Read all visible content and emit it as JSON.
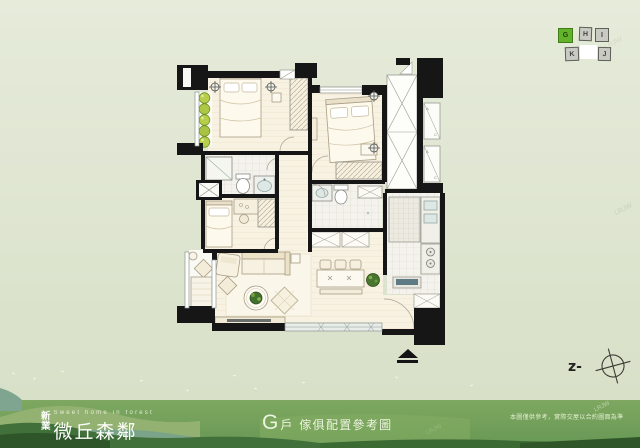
{
  "keyplan": {
    "units": [
      {
        "label": "G",
        "highlight": true
      },
      {
        "label": "H",
        "highlight": false
      },
      {
        "label": "I",
        "highlight": false
      },
      {
        "label": "K",
        "highlight": false
      },
      {
        "label": "J",
        "highlight": false
      }
    ],
    "highlight_color": "#63b22b"
  },
  "compass": {
    "label": "z-"
  },
  "plan": {
    "ac_labels": [
      "A",
      "C",
      "A",
      "C"
    ]
  },
  "footer": {
    "brand_char_top": "新",
    "brand_char_bottom": "業",
    "tagline": "Sweet home in forest",
    "brand_name": "微丘森鄰",
    "unit_letter": "G",
    "unit_word": "戶",
    "title_rest": "傢俱配置參考圖",
    "disclaimer": "本圖僅供參考，實際交屋以合約圖面為準",
    "watermark": "LRJW",
    "band_green": "#6f9c53"
  }
}
